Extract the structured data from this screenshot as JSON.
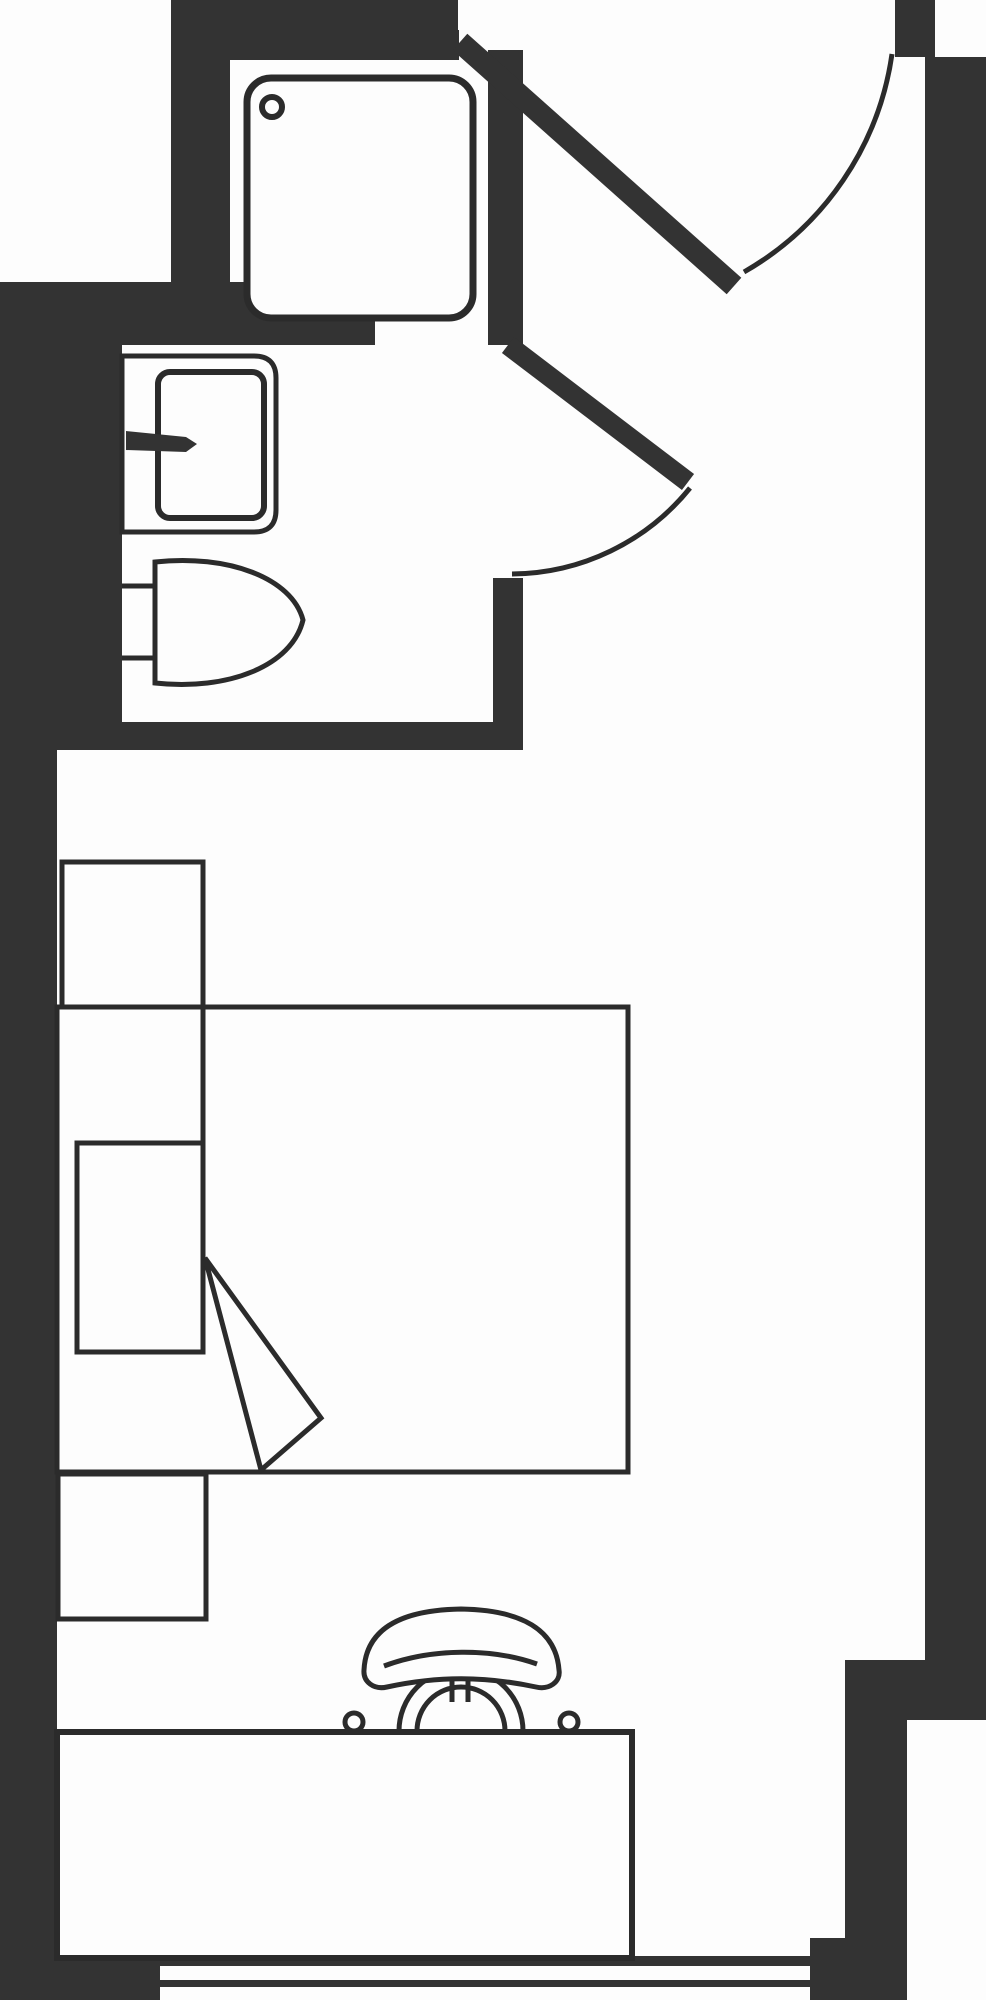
{
  "meta": {
    "title": "Studio room floor plan",
    "description": "Black and white architectural floor plan of a studio room with en-suite bathroom (shower tray, wash basin, toilet), entry door with swing arc, bathroom door with swing arc, bed with pillow and folded blanket corner, headboard cabinet, bedside cabinet, desk with task chair, and a window band along the bottom wall.",
    "canvas": {
      "width": 986,
      "height": 2000
    }
  },
  "colors": {
    "wall": "#333333",
    "line": "#2b2b2b",
    "paper": "#fdfdfd"
  },
  "rooms": [
    {
      "name": "bathroom",
      "fixtures": [
        "shower-tray",
        "shower-drain",
        "wash-basin",
        "tap",
        "toilet"
      ]
    },
    {
      "name": "bedroom",
      "fixtures": [
        "bed",
        "pillow",
        "blanket-fold",
        "headboard-cabinet",
        "bedside-cabinet",
        "desk",
        "chair"
      ]
    }
  ],
  "doors": [
    {
      "name": "entry-door",
      "swing": "inward from top wall toward right wall"
    },
    {
      "name": "bathroom-door",
      "swing": "inward from bathroom pier toward bedroom"
    }
  ],
  "window": {
    "name": "bottom-window-band",
    "style": "double parallel lines between wall blocks"
  }
}
